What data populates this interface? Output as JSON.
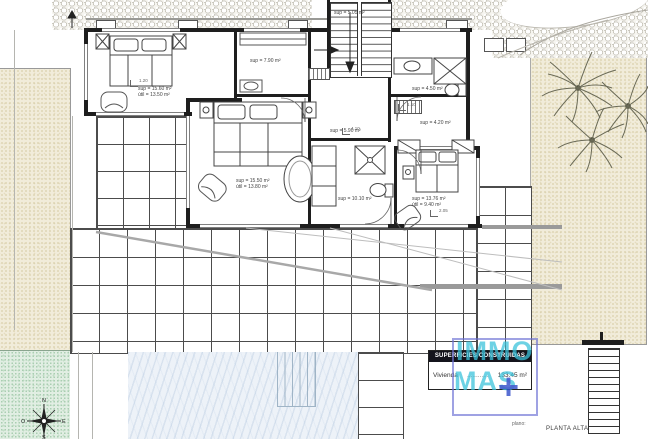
{
  "plan": {
    "prefix": "plano:",
    "name": "PLANTA ALTA"
  },
  "title_block": {
    "header": "SUPERFICIES CONSTRUIDAS",
    "row_label": "Vivienda",
    "row_leader": "............",
    "row_value": "133.45 m²"
  },
  "logo": {
    "line1": "IMMO",
    "line2": "MAS",
    "plus": "+",
    "colors": {
      "text": "#3cc3da",
      "plus": "#2d49c8",
      "border": "#6e72d4"
    }
  },
  "compass": {
    "north": "N",
    "east": "E",
    "south": "S",
    "west": "O"
  },
  "rooms": [
    {
      "id": "bedroom-1",
      "area": "sup = 15.60 m²",
      "useful": "útil = 13.50 m²"
    },
    {
      "id": "dressing-room",
      "area": "sup = 7.90 m²"
    },
    {
      "id": "staircase",
      "area": "sup = 5.05 m²"
    },
    {
      "id": "bathroom-2",
      "area": "sup = 4.50 m²"
    },
    {
      "id": "laundry",
      "area": "sup = 4.20 m²"
    },
    {
      "id": "hallway",
      "area": "sup = 5.90 m²"
    },
    {
      "id": "master-bedroom",
      "area": "sup = 15.50 m²",
      "useful": "útil = 13.80 m²"
    },
    {
      "id": "master-bathroom",
      "area": "sup = 10.10 m²"
    },
    {
      "id": "bedroom-2",
      "area": "sup = 13.76 m²",
      "useful": "útil = 9.40 m²"
    }
  ],
  "dimensions": {
    "d1": "1.20",
    "d2": "1.10",
    "d3": "4.10",
    "d4": "2.05"
  },
  "colors": {
    "header_bar": "#14141c",
    "pool_water": "#edf2f8",
    "wall": "#1e1e1e"
  }
}
